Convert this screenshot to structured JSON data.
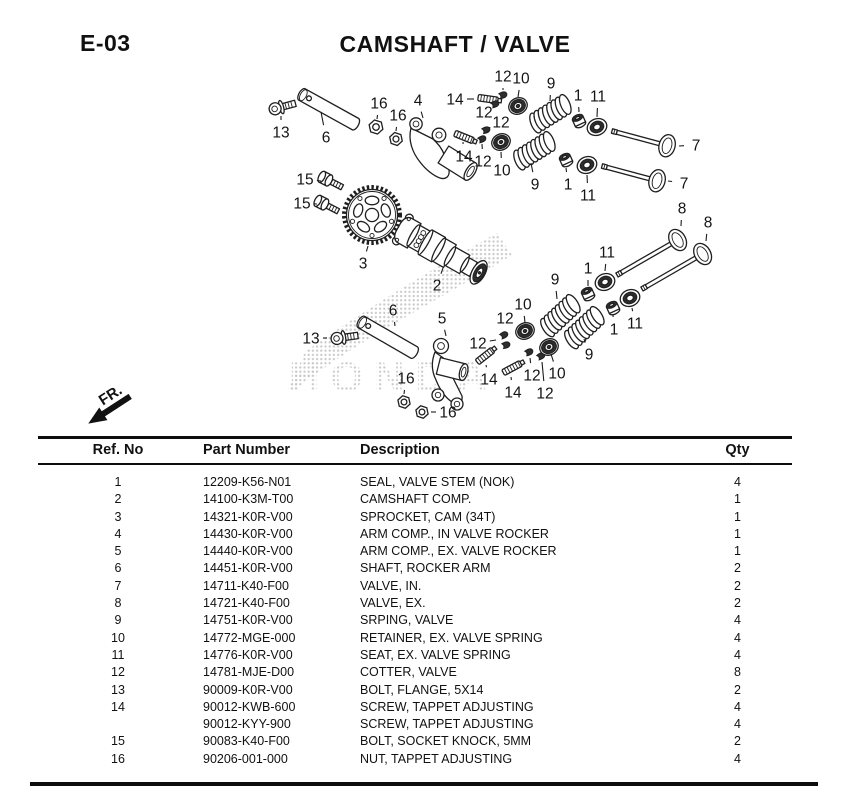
{
  "header": {
    "code": "E-03",
    "title": "CAMSHAFT / VALVE"
  },
  "diagram": {
    "fr_label": "FR.",
    "watermark": "HONDA",
    "callouts": [
      {
        "n": "13",
        "x": 281,
        "y": 132,
        "tx": 281,
        "ty": 116
      },
      {
        "n": "6",
        "x": 326,
        "y": 137,
        "tx": 321,
        "ty": 112
      },
      {
        "n": "16",
        "x": 379,
        "y": 103,
        "tx": 377,
        "ty": 119
      },
      {
        "n": "16",
        "x": 398,
        "y": 115,
        "tx": 396,
        "ty": 131
      },
      {
        "n": "4",
        "x": 418,
        "y": 100,
        "tx": 423,
        "ty": 118
      },
      {
        "n": "14",
        "x": 455,
        "y": 99,
        "tx": 474,
        "ty": 99
      },
      {
        "n": "12",
        "x": 503,
        "y": 76,
        "tx": 503,
        "ty": 90
      },
      {
        "n": "10",
        "x": 521,
        "y": 78,
        "tx": 518,
        "ty": 97
      },
      {
        "n": "9",
        "x": 551,
        "y": 83,
        "tx": 550,
        "ty": 101
      },
      {
        "n": "1",
        "x": 578,
        "y": 95,
        "tx": 579,
        "ty": 112
      },
      {
        "n": "11",
        "x": 598,
        "y": 96,
        "tx": 597,
        "ty": 117
      },
      {
        "n": "12",
        "x": 484,
        "y": 112,
        "tx": 492,
        "ty": 102
      },
      {
        "n": "12",
        "x": 501,
        "y": 122,
        "tx": 489,
        "ty": 128
      },
      {
        "n": "14",
        "x": 464,
        "y": 156,
        "tx": 463,
        "ty": 142
      },
      {
        "n": "12",
        "x": 483,
        "y": 161,
        "tx": 482,
        "ty": 144
      },
      {
        "n": "10",
        "x": 502,
        "y": 170,
        "tx": 501,
        "ty": 152
      },
      {
        "n": "9",
        "x": 535,
        "y": 184,
        "tx": 531,
        "ty": 163
      },
      {
        "n": "1",
        "x": 568,
        "y": 184,
        "tx": 566,
        "ty": 168
      },
      {
        "n": "11",
        "x": 588,
        "y": 195,
        "tx": 587,
        "ty": 175
      },
      {
        "n": "7",
        "x": 696,
        "y": 145,
        "tx": 679,
        "ty": 146
      },
      {
        "n": "7",
        "x": 684,
        "y": 183,
        "tx": 668,
        "ty": 181
      },
      {
        "n": "15",
        "x": 305,
        "y": 179,
        "tx": 321,
        "ty": 181
      },
      {
        "n": "15",
        "x": 302,
        "y": 203,
        "tx": 317,
        "ty": 204
      },
      {
        "n": "3",
        "x": 363,
        "y": 263,
        "tx": 368,
        "ty": 246
      },
      {
        "n": "2",
        "x": 437,
        "y": 285,
        "tx": 443,
        "ty": 268
      },
      {
        "n": "6",
        "x": 393,
        "y": 310,
        "tx": 395,
        "ty": 326
      },
      {
        "n": "13",
        "x": 311,
        "y": 338,
        "tx": 327,
        "ty": 338
      },
      {
        "n": "5",
        "x": 442,
        "y": 318,
        "tx": 446,
        "ty": 336
      },
      {
        "n": "16",
        "x": 406,
        "y": 378,
        "tx": 404,
        "ty": 394
      },
      {
        "n": "16",
        "x": 448,
        "y": 412,
        "tx": 431,
        "ty": 412
      },
      {
        "n": "14",
        "x": 489,
        "y": 379,
        "tx": 486,
        "ty": 365
      },
      {
        "n": "14",
        "x": 513,
        "y": 392,
        "tx": 511,
        "ty": 377
      },
      {
        "n": "12",
        "x": 505,
        "y": 318,
        "tx": 505,
        "ty": 330
      },
      {
        "n": "12",
        "x": 478,
        "y": 343,
        "tx": 496,
        "ty": 340
      },
      {
        "n": "12",
        "x": 532,
        "y": 375,
        "tx": 530,
        "ty": 358
      },
      {
        "n": "12",
        "x": 545,
        "y": 393,
        "tx": 542,
        "ty": 362
      },
      {
        "n": "10",
        "x": 523,
        "y": 304,
        "tx": 525,
        "ty": 323
      },
      {
        "n": "9",
        "x": 555,
        "y": 279,
        "tx": 557,
        "ty": 299
      },
      {
        "n": "10",
        "x": 557,
        "y": 373,
        "tx": 551,
        "ty": 354
      },
      {
        "n": "9",
        "x": 589,
        "y": 354,
        "tx": 584,
        "ty": 339
      },
      {
        "n": "1",
        "x": 588,
        "y": 268,
        "tx": 588,
        "ty": 286
      },
      {
        "n": "1",
        "x": 614,
        "y": 329,
        "tx": 613,
        "ty": 315
      },
      {
        "n": "11",
        "x": 607,
        "y": 252,
        "tx": 605,
        "ty": 271
      },
      {
        "n": "11",
        "x": 635,
        "y": 323,
        "tx": 632,
        "ty": 308
      },
      {
        "n": "8",
        "x": 682,
        "y": 208,
        "tx": 681,
        "ty": 226
      },
      {
        "n": "8",
        "x": 708,
        "y": 222,
        "tx": 706,
        "ty": 241
      }
    ]
  },
  "table": {
    "headers": [
      "Ref. No",
      "Part Number",
      "Description",
      "Qty"
    ],
    "rows": [
      {
        "ref": "1",
        "part": "12209-K56-N01",
        "desc": "SEAL, VALVE STEM (NOK)",
        "qty": "4"
      },
      {
        "ref": "2",
        "part": "14100-K3M-T00",
        "desc": "CAMSHAFT COMP.",
        "qty": "1"
      },
      {
        "ref": "3",
        "part": "14321-K0R-V00",
        "desc": "SPROCKET, CAM (34T)",
        "qty": "1"
      },
      {
        "ref": "4",
        "part": "14430-K0R-V00",
        "desc": "ARM COMP., IN VALVE ROCKER",
        "qty": "1"
      },
      {
        "ref": "5",
        "part": "14440-K0R-V00",
        "desc": "ARM COMP., EX. VALVE ROCKER",
        "qty": "1"
      },
      {
        "ref": "6",
        "part": "14451-K0R-V00",
        "desc": "SHAFT, ROCKER ARM",
        "qty": "2"
      },
      {
        "ref": "7",
        "part": "14711-K40-F00",
        "desc": "VALVE, IN.",
        "qty": "2"
      },
      {
        "ref": "8",
        "part": "14721-K40-F00",
        "desc": "VALVE, EX.",
        "qty": "2"
      },
      {
        "ref": "9",
        "part": "14751-K0R-V00",
        "desc": "SRPING, VALVE",
        "qty": "4"
      },
      {
        "ref": "10",
        "part": "14772-MGE-000",
        "desc": "RETAINER, EX. VALVE SPRING",
        "qty": "4"
      },
      {
        "ref": "11",
        "part": "14776-K0R-V00",
        "desc": "SEAT, EX. VALVE SPRING",
        "qty": "4"
      },
      {
        "ref": "12",
        "part": "14781-MJE-D00",
        "desc": "COTTER, VALVE",
        "qty": "8"
      },
      {
        "ref": "13",
        "part": "90009-K0R-V00",
        "desc": "BOLT, FLANGE, 5X14",
        "qty": "2"
      },
      {
        "ref": "14",
        "part": "90012-KWB-600",
        "desc": "SCREW, TAPPET ADJUSTING",
        "qty": "4"
      },
      {
        "ref": "",
        "part": "90012-KYY-900",
        "desc": "SCREW, TAPPET ADJUSTING",
        "qty": "4"
      },
      {
        "ref": "15",
        "part": "90083-K40-F00",
        "desc": "BOLT, SOCKET KNOCK, 5MM",
        "qty": "2"
      },
      {
        "ref": "16",
        "part": "90206-001-000",
        "desc": "NUT, TAPPET ADJUSTING",
        "qty": "4"
      }
    ]
  },
  "colors": {
    "ink": "#111111",
    "line": "#1f1f1f",
    "watermark_dot": "#c9c9c9"
  }
}
